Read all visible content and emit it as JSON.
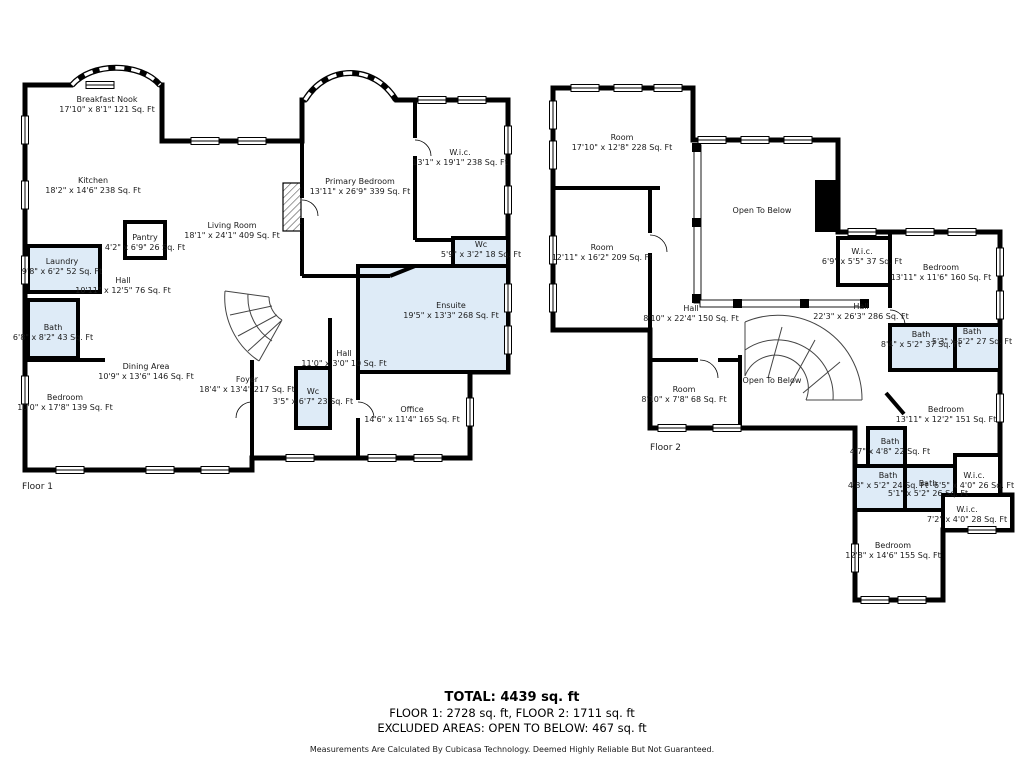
{
  "colors": {
    "wall": "#000000",
    "wet_room": "#deebf7",
    "background": "#ffffff",
    "text": "#1a1a1a"
  },
  "floor1": {
    "label": "Floor 1",
    "rooms": [
      {
        "name": "Breakfast Nook",
        "dims": "17'10\" x 8'1\" 121 Sq. Ft"
      },
      {
        "name": "Kitchen",
        "dims": "18'2\" x 14'6\" 238 Sq. Ft"
      },
      {
        "name": "Primary Bedroom",
        "dims": "13'11\" x 26'9\" 339 Sq. Ft"
      },
      {
        "name": "W.i.c.",
        "dims": "13'1\" x 19'1\" 238 Sq. Ft"
      },
      {
        "name": "Living Room",
        "dims": "18'1\" x 24'1\" 409 Sq. Ft"
      },
      {
        "name": "Pantry",
        "dims": "4'2\" x 6'9\" 26 Sq. Ft"
      },
      {
        "name": "Laundry",
        "dims": "9'8\" x 6'2\" 52 Sq. Ft"
      },
      {
        "name": "Hall",
        "dims": "10'11\" x 12'5\" 76 Sq. Ft"
      },
      {
        "name": "Wc",
        "dims": "5'9\" x 3'2\" 18 Sq. Ft"
      },
      {
        "name": "Bath",
        "dims": "6'8\" x 8'2\" 43 Sq. Ft"
      },
      {
        "name": "Ensuite",
        "dims": "19'5\" x 13'3\" 268 Sq. Ft"
      },
      {
        "name": "Dining Area",
        "dims": "10'9\" x 13'6\" 146 Sq. Ft"
      },
      {
        "name": "Hall",
        "dims": "11'0\" x 3'0\" 10 Sq. Ft"
      },
      {
        "name": "Foyer",
        "dims": "18'4\" x 13'4\" 217 Sq. Ft"
      },
      {
        "name": "Wc",
        "dims": "3'5\" x 6'7\" 23 Sq. Ft"
      },
      {
        "name": "Bedroom",
        "dims": "10'0\" x 17'8\" 139 Sq. Ft"
      },
      {
        "name": "Office",
        "dims": "14'6\" x 11'4\" 165 Sq. Ft"
      }
    ]
  },
  "floor2": {
    "label": "Floor 2",
    "rooms": [
      {
        "name": "Room",
        "dims": "17'10\" x 12'8\" 228 Sq. Ft"
      },
      {
        "name": "Open To Below",
        "dims": ""
      },
      {
        "name": "Room",
        "dims": "12'11\" x 16'2\" 209 Sq. Ft"
      },
      {
        "name": "W.i.c.",
        "dims": "6'9\" x 5'5\" 37 Sq. Ft"
      },
      {
        "name": "Bedroom",
        "dims": "13'11\" x 11'6\" 160 Sq. Ft"
      },
      {
        "name": "Hall",
        "dims": "8'10\" x 22'4\" 150 Sq. Ft"
      },
      {
        "name": "Hall",
        "dims": "22'3\" x 26'3\" 286 Sq. Ft"
      },
      {
        "name": "Bath",
        "dims": "8'4\" x 5'2\" 37 Sq. Ft"
      },
      {
        "name": "Bath",
        "dims": "5'3\" x 5'2\" 27 Sq. Ft"
      },
      {
        "name": "Open To Below",
        "dims": ""
      },
      {
        "name": "Room",
        "dims": "8'10\" x 7'8\" 68 Sq. Ft"
      },
      {
        "name": "Bedroom",
        "dims": "13'11\" x 12'2\" 151 Sq. Ft"
      },
      {
        "name": "Bath",
        "dims": "4'7\" x 4'8\" 22 Sq. Ft"
      },
      {
        "name": "Bath",
        "dims": "4'8\" x 5'2\" 24 Sq. Ft"
      },
      {
        "name": "Bath",
        "dims": "5'1\" x 5'2\" 26 Sq. Ft"
      },
      {
        "name": "W.i.c.",
        "dims": "6'5\" x 4'0\" 26 Sq. Ft"
      },
      {
        "name": "W.i.c.",
        "dims": "7'2\" x 4'0\" 28 Sq. Ft"
      },
      {
        "name": "Bedroom",
        "dims": "12'8\" x 14'6\" 155 Sq. Ft"
      }
    ]
  },
  "footer": {
    "total": "TOTAL: 4439 sq. ft",
    "floors_line": "FLOOR 1: 2728 sq. ft, FLOOR 2: 1711 sq. ft",
    "excluded_line": "EXCLUDED AREAS: OPEN TO BELOW: 467 sq. ft",
    "disclaimer": "Measurements Are Calculated By Cubicasa Technology. Deemed Highly Reliable But Not Guaranteed."
  }
}
